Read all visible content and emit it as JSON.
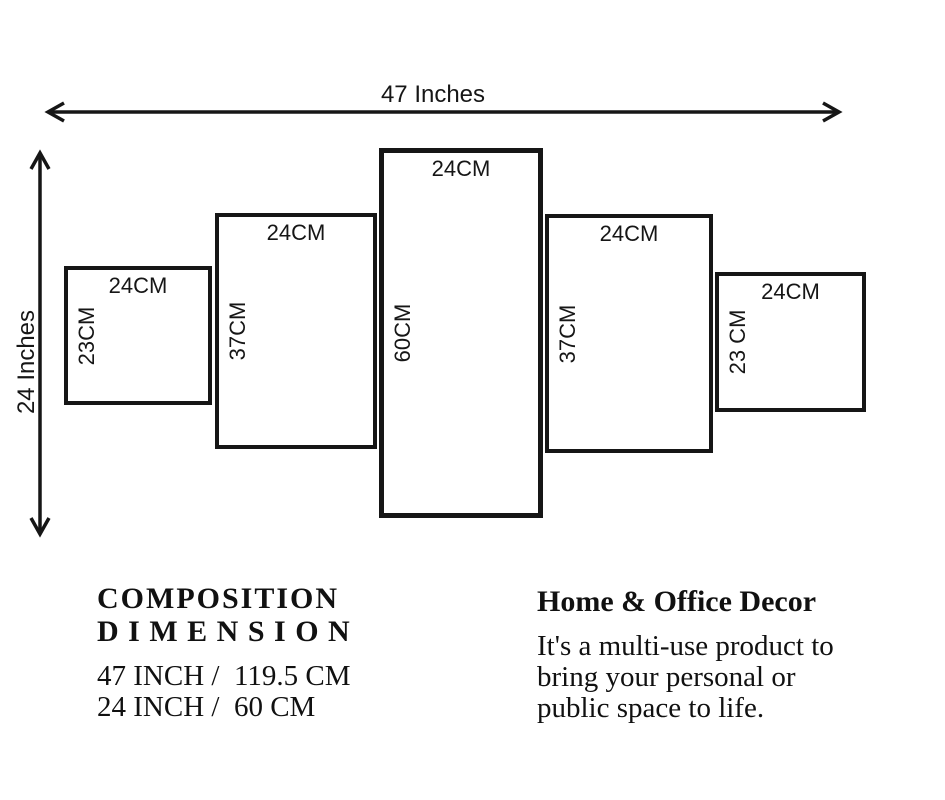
{
  "diagram": {
    "width_label": "47 Inches",
    "height_label": "24 Inches",
    "panels": [
      {
        "top_label": "24CM",
        "side_label": "23CM"
      },
      {
        "top_label": "24CM",
        "side_label": "37CM"
      },
      {
        "top_label": "24CM",
        "side_label": "60CM"
      },
      {
        "top_label": "24CM",
        "side_label": "37CM"
      },
      {
        "top_label": "24CM",
        "side_label": "23 CM"
      }
    ]
  },
  "composition": {
    "heading_line1": "COMPOSITION",
    "heading_line2": "D I M E N S I O N",
    "rows": [
      "47 INCH /  119.5 CM",
      "24 INCH /  60 CM"
    ]
  },
  "decor": {
    "heading": "Home & Office Decor",
    "body_lines": [
      "It's a multi-use product to",
      "bring your personal or",
      "public space to life."
    ]
  },
  "colors": {
    "ink": "#161616",
    "background": "#ffffff"
  }
}
